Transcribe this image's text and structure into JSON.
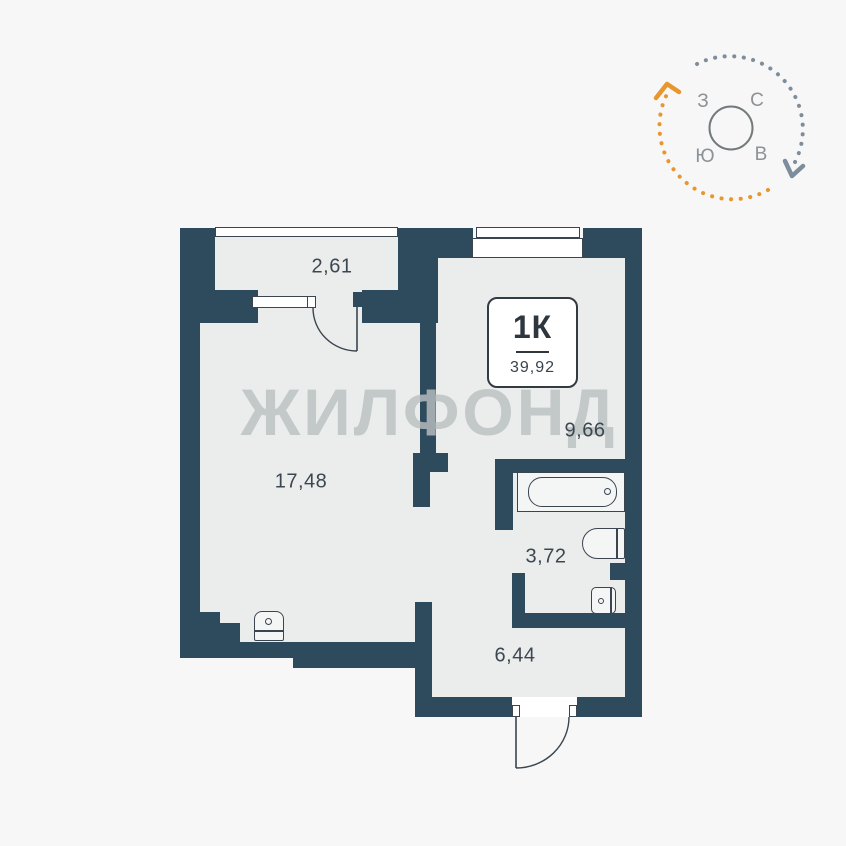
{
  "plan": {
    "watermark": "ЖИЛФОНД",
    "unit_badge": {
      "unit_type": "1К",
      "total_area": "39,92"
    },
    "rooms": {
      "balcony": {
        "area": "2,61"
      },
      "living": {
        "area": "17,48"
      },
      "bedroom": {
        "area": "9,66"
      },
      "bathroom": {
        "area": "3,72"
      },
      "hallway": {
        "area": "6,44"
      }
    }
  },
  "compass": {
    "letters": {
      "west": "З",
      "north": "С",
      "south": "Ю",
      "east": "В"
    }
  },
  "colors": {
    "wall": "#2d4b5d",
    "floor": "#ebedec",
    "background": "#f6f7f6",
    "outline": "#3a454f",
    "label_text": "#3d4751",
    "watermark": "#bac0c1",
    "compass_orange": "#e8962e",
    "compass_gray": "#7e8d9c"
  }
}
